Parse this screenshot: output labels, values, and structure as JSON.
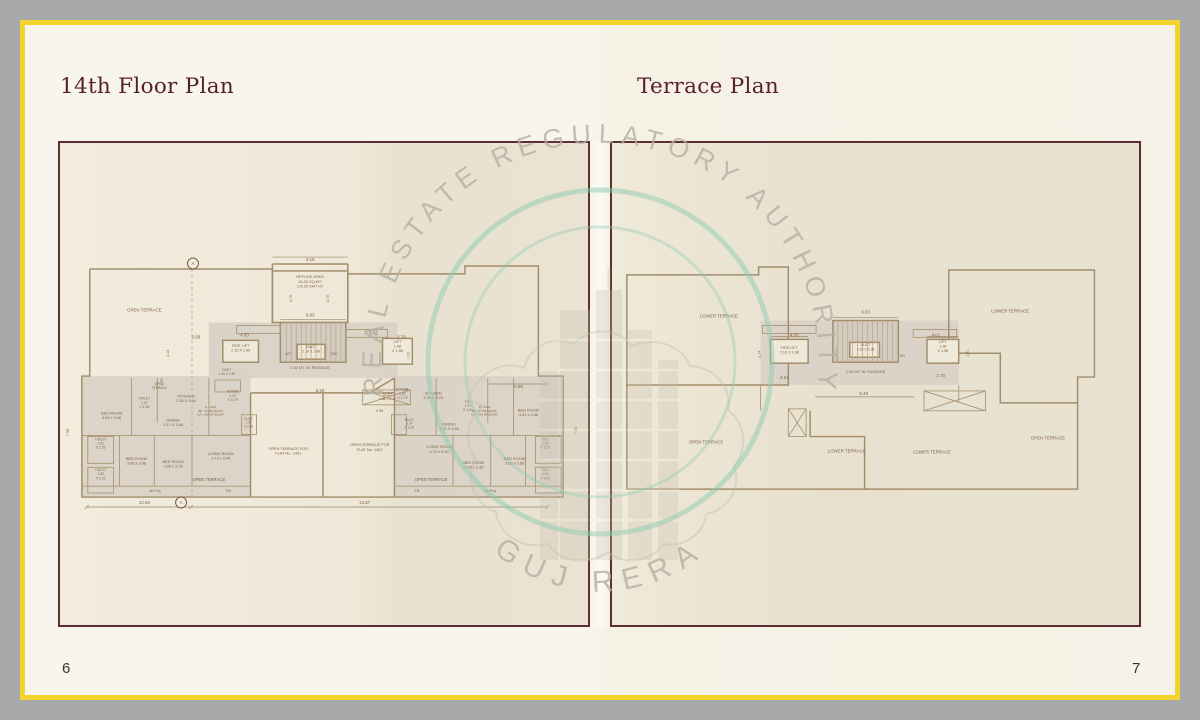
{
  "titles": {
    "left": "14th Floor Plan",
    "right": "Terrace Plan"
  },
  "page": {
    "left_number": "6",
    "right_number": "7"
  },
  "watermark": {
    "arc_text": "REAL ESTATE REGULATORY AUTHORITY",
    "bottom_text": "GUJ RERA",
    "circle_color": "#8ecbb2",
    "text_color": "#b5b0a5"
  },
  "colors": {
    "frame_yellow": "#f2d52e",
    "frame_gray": "#a7a9ab",
    "page_cream": "#f8f5ec",
    "panel_border": "#5c2f33",
    "title_maroon": "#571f2c",
    "plan_wall_tan": "#a38d6b",
    "plan_fill": "#d9d1c5",
    "plan_text": "#7d5f45"
  },
  "floor_plan": {
    "section_marker": "A",
    "labels": [
      {
        "x": 252,
        "y": 119,
        "t": "3.19"
      },
      {
        "x": 252,
        "y": 141,
        "t": "REFUGE AREA\n16.00 SQ.MT.\nC/6.25 SMT HT",
        "s": 3.9
      },
      {
        "x": 252,
        "y": 175,
        "t": "6.83"
      },
      {
        "x": 234,
        "y": 157,
        "t": "4.70",
        "r": -90,
        "s": 3.8
      },
      {
        "x": 271,
        "y": 157,
        "t": "4.70",
        "r": -90,
        "s": 3.8
      },
      {
        "x": 186,
        "y": 195,
        "t": "4.93"
      },
      {
        "x": 316,
        "y": 193,
        "t": "4.01"
      },
      {
        "x": 137,
        "y": 197,
        "t": "2.58"
      },
      {
        "x": 344,
        "y": 197,
        "t": "2.79"
      },
      {
        "x": 110,
        "y": 212,
        "t": "2.14",
        "r": -90,
        "s": 3.8
      },
      {
        "x": 352,
        "y": 214,
        "t": "1.91",
        "r": -90,
        "s": 3.8
      },
      {
        "x": 104,
        "y": 241,
        "t": "1.70",
        "r": -90,
        "s": 3.8
      },
      {
        "x": 182,
        "y": 208,
        "t": "FIRE LIFT\n2.10 X 1.98",
        "s": 3.8
      },
      {
        "x": 340,
        "y": 206,
        "t": "LIFT\n1.98\nX 1.98",
        "s": 3.8
      },
      {
        "x": 253,
        "y": 209,
        "t": "DUCT\n2.10 X 1.98",
        "s": 3.5
      },
      {
        "x": 230,
        "y": 214,
        "t": "UP",
        "s": 3.8
      },
      {
        "x": 276,
        "y": 214,
        "t": "DN",
        "s": 3.8
      },
      {
        "x": 252,
        "y": 228,
        "t": "2.40 MT. W. PASSAGE",
        "s": 3.9
      },
      {
        "x": 85,
        "y": 170,
        "t": "OPEN  TERRACE",
        "s": 4.4
      },
      {
        "x": 100,
        "y": 246,
        "t": "OPEN\nTERRACE",
        "s": 3.2
      },
      {
        "x": 168,
        "y": 232,
        "t": "DUCT\n1.40 X 1.36",
        "s": 3.2
      },
      {
        "x": 52,
        "y": 276,
        "t": "BED ROOM\n3.81 x 3.66",
        "s": 3.9
      },
      {
        "x": 85,
        "y": 263,
        "t": "TOILET\n1.37\nX 1.94",
        "s": 3.5
      },
      {
        "x": 127,
        "y": 259,
        "t": "KITCHEN\n3.35 X 3.04",
        "s": 3.9
      },
      {
        "x": 174,
        "y": 256,
        "t": "FOYER\n1.37\nX 1.79",
        "s": 3.5
      },
      {
        "x": 114,
        "y": 283,
        "t": "DINING\n3.12 X 3.66",
        "s": 3.9
      },
      {
        "x": 152,
        "y": 271,
        "t": "A - 1401\nBP.: 97.58 SQ.MT.\nCA.: 104.90 SQ.MT.",
        "s": 3.1
      },
      {
        "x": 190,
        "y": 283,
        "t": "DUCT\n1.37\nX 2.29",
        "s": 3.2
      },
      {
        "x": 41,
        "y": 304,
        "t": "TOILET\n1.52\nX 1.52",
        "s": 3.4
      },
      {
        "x": 41,
        "y": 335,
        "t": "TOILET\n1.52\nX 2.02",
        "s": 3.4
      },
      {
        "x": 77,
        "y": 322,
        "t": "BED ROOM\n3.66 x 3.66",
        "s": 3.9
      },
      {
        "x": 114,
        "y": 325,
        "t": "BED ROOM\n3.05 x 3.35",
        "s": 3.9
      },
      {
        "x": 162,
        "y": 317,
        "t": "LIVING ROOM\n3.73 x 5.49",
        "s": 3.9
      },
      {
        "x": 150,
        "y": 341,
        "t": "OPEN TERRACE",
        "s": 4.2
      },
      {
        "x": 96,
        "y": 352,
        "t": "Air Proj.",
        "s": 3.4
      },
      {
        "x": 170,
        "y": 352,
        "t": "F.B.",
        "s": 3.2
      },
      {
        "x": 230,
        "y": 312,
        "t": "OPEN TERRACE FOR\nFLAT No. 1401",
        "s": 3.9
      },
      {
        "x": 312,
        "y": 308,
        "t": "OPEN TERRACE FOR\nFLAT No. 1402",
        "s": 3.9
      },
      {
        "x": 262,
        "y": 251,
        "t": "5.25"
      },
      {
        "x": 330,
        "y": 257,
        "t": "DUCT\n4.88 X 2.12",
        "s": 3.3
      },
      {
        "x": 322,
        "y": 271,
        "t": "4.39",
        "s": 3.8
      },
      {
        "x": 462,
        "y": 247,
        "t": "5.98"
      },
      {
        "x": 345,
        "y": 254,
        "t": "FOYER\n1.37\nX 1.79",
        "s": 3.5
      },
      {
        "x": 376,
        "y": 256,
        "t": "KITCHEN\n3.35 X 3.04",
        "s": 3.9
      },
      {
        "x": 411,
        "y": 266,
        "t": "TOI.\n1.37\nX 1.94",
        "s": 3.4
      },
      {
        "x": 472,
        "y": 273,
        "t": "BED ROOM\n3.81 x 3.66",
        "s": 3.9
      },
      {
        "x": 392,
        "y": 287,
        "t": "DINING\n3.12 X 3.66",
        "s": 3.9
      },
      {
        "x": 428,
        "y": 271,
        "t": "B - 1402\nBP.: 97.58 SQ.MT.\nCA.: 104.90 SQ.MT.",
        "s": 3.1
      },
      {
        "x": 352,
        "y": 284,
        "t": "DUCT\n1.37\nX 2.29",
        "s": 3.2
      },
      {
        "x": 382,
        "y": 310,
        "t": "LIVING ROOM\n3.73 x 5.49",
        "s": 3.9
      },
      {
        "x": 417,
        "y": 326,
        "t": "BED ROOM\n3.05 x 3.35",
        "s": 3.9
      },
      {
        "x": 458,
        "y": 322,
        "t": "BED ROOM\n3.66 x 3.66",
        "s": 3.9
      },
      {
        "x": 489,
        "y": 304,
        "t": "TOI.\n1.52\nX 1.52",
        "s": 3.4
      },
      {
        "x": 489,
        "y": 335,
        "t": "TOI.\n1.52\nX 2.02",
        "s": 3.4
      },
      {
        "x": 374,
        "y": 341,
        "t": "OPEN TERRACE",
        "s": 4.2
      },
      {
        "x": 434,
        "y": 352,
        "t": "Air Proj.",
        "s": 3.4
      },
      {
        "x": 360,
        "y": 352,
        "t": "F.B.",
        "s": 3.2
      },
      {
        "x": 85,
        "y": 364,
        "t": "12.50"
      },
      {
        "x": 307,
        "y": 364,
        "t": "14.57"
      },
      {
        "x": 9,
        "y": 292,
        "t": "7.96",
        "r": -90,
        "s": 3.8
      },
      {
        "x": 521,
        "y": 290,
        "t": "7.58",
        "r": -90,
        "s": 3.8
      },
      {
        "x": 134,
        "y": 123,
        "t": "A",
        "s": 4.5
      },
      {
        "x": 122,
        "y": 364,
        "t": "A",
        "s": 4.5
      }
    ]
  },
  "terrace_plan": {
    "labels": [
      {
        "x": 108,
        "y": 176,
        "t": "LOWER  TERRACE",
        "s": 4.4
      },
      {
        "x": 402,
        "y": 171,
        "t": "LOWER  TERRACE",
        "s": 4.4
      },
      {
        "x": 256,
        "y": 172,
        "t": "6.83"
      },
      {
        "x": 184,
        "y": 195,
        "t": "4.93"
      },
      {
        "x": 327,
        "y": 195,
        "t": "4.01"
      },
      {
        "x": 150,
        "y": 213,
        "t": "2.14",
        "r": -90,
        "s": 3.8
      },
      {
        "x": 360,
        "y": 212,
        "t": "1.91",
        "r": -90,
        "s": 3.8
      },
      {
        "x": 179,
        "y": 210,
        "t": "FIRE LIFT\n2.10 X 1.98",
        "s": 3.8
      },
      {
        "x": 334,
        "y": 206,
        "t": "LIFT\n1.98\nX 1.98",
        "s": 3.8
      },
      {
        "x": 256,
        "y": 207,
        "t": "DUCT\n2.10 X 1.98",
        "s": 3.5
      },
      {
        "x": 293,
        "y": 216,
        "t": "DN",
        "s": 3.8
      },
      {
        "x": 256,
        "y": 232,
        "t": "2.40 MT. W. PASSAGE",
        "s": 3.9
      },
      {
        "x": 174,
        "y": 238,
        "t": "3.51"
      },
      {
        "x": 332,
        "y": 236,
        "t": "2.70"
      },
      {
        "x": 254,
        "y": 254,
        "t": "9.46"
      },
      {
        "x": 95,
        "y": 303,
        "t": "OPEN  TERRACE",
        "s": 4.4
      },
      {
        "x": 237,
        "y": 312,
        "t": "LOWER  TERRACE",
        "s": 4.4
      },
      {
        "x": 323,
        "y": 313,
        "t": "LOWER  TERRACE",
        "s": 4.4
      },
      {
        "x": 440,
        "y": 299,
        "t": "OPEN  TERRACE",
        "s": 4.4
      }
    ]
  }
}
